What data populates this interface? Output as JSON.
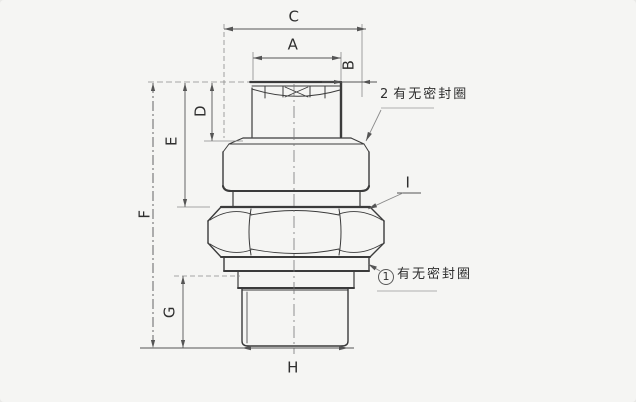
{
  "colors": {
    "background": "#f5f5f3",
    "line": "#3b3b3b",
    "dim_line": "#555555",
    "text": "#2f2f2f"
  },
  "dimension_labels": {
    "a": "A",
    "b": "B",
    "c": "C",
    "d": "D",
    "e": "E",
    "f": "F",
    "g": "G",
    "h": "H",
    "i": "I"
  },
  "annotations": {
    "seal_ring_top": {
      "number": "2",
      "text": "有无密封圈"
    },
    "seal_ring_bottom": {
      "number": "1",
      "text": "有无密封圈"
    }
  }
}
